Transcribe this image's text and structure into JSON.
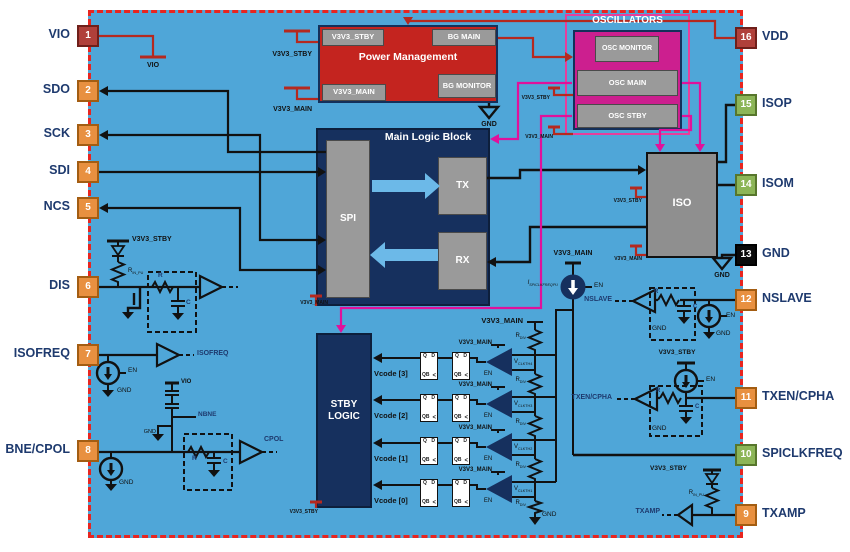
{
  "pins": {
    "left": [
      {
        "num": "1",
        "label": "VIO",
        "type": "power"
      },
      {
        "num": "2",
        "label": "SDO",
        "type": "io"
      },
      {
        "num": "3",
        "label": "SCK",
        "type": "io"
      },
      {
        "num": "4",
        "label": "SDI",
        "type": "io"
      },
      {
        "num": "5",
        "label": "NCS",
        "type": "io"
      },
      {
        "num": "6",
        "label": "DIS",
        "type": "io"
      },
      {
        "num": "7",
        "label": "ISOFREQ",
        "type": "io"
      },
      {
        "num": "8",
        "label": "BNE/CPOL",
        "type": "io"
      }
    ],
    "right": [
      {
        "num": "16",
        "label": "VDD",
        "type": "power"
      },
      {
        "num": "15",
        "label": "ISOP",
        "type": "iso"
      },
      {
        "num": "14",
        "label": "ISOM",
        "type": "iso"
      },
      {
        "num": "13",
        "label": "GND",
        "type": "ground"
      },
      {
        "num": "12",
        "label": "NSLAVE",
        "type": "io"
      },
      {
        "num": "11",
        "label": "TXEN/CPHA",
        "type": "io"
      },
      {
        "num": "10",
        "label": "SPICLKFREQ",
        "type": "iso"
      },
      {
        "num": "9",
        "label": "TXAMP",
        "type": "io"
      }
    ]
  },
  "blocks": {
    "power_management": {
      "title": "Power Management",
      "v3v3_stby": "V3V3_STBY",
      "bg_main": "BG MAIN",
      "v3v3_main": "V3V3_MAIN",
      "bg_monitor": "BG MONITOR"
    },
    "oscillators": {
      "title": "OSCILLATORS",
      "osc_monitor": "OSC MONITOR",
      "osc_main": "OSC MAIN",
      "osc_stby": "OSC STBY"
    },
    "main_logic": {
      "title": "Main Logic Block",
      "spi": "SPI",
      "tx": "TX",
      "rx": "RX"
    },
    "iso": {
      "title": "ISO"
    },
    "stby_logic": {
      "line1": "STBY",
      "line2": "LOGIC"
    }
  },
  "labels": {
    "vio": "VIO",
    "v3v3_stby": "V3V3_STBY",
    "v3v3_main": "V3V3_MAIN",
    "gnd": "GND",
    "en": "EN",
    "nbne": "NBNE",
    "isofreq": "ISOFREQ",
    "cpol": "CPOL",
    "nslave": "NSLAVE",
    "txen_cpha": "TXEN/CPHA",
    "txamp": "TXAMP",
    "r": "R",
    "c": "C"
  },
  "subs": {
    "r_in_pu": {
      "base": "R",
      "sub": "IN_PU"
    },
    "i_spiclkfreq": {
      "base": "I",
      "sub": "SPICLKFREQPU"
    },
    "r_div": {
      "base": "R",
      "sub": "DIV"
    }
  },
  "ff": {
    "q": "Q",
    "d": "D",
    "qb": "QB",
    "clk": "<"
  },
  "stby_rows": [
    {
      "vcode": "Vcode [3]",
      "vth_base": "V",
      "vth_sub": "CLKTH4"
    },
    {
      "vcode": "Vcode [2]",
      "vth_base": "V",
      "vth_sub": "CLKTH3"
    },
    {
      "vcode": "Vcode [1]",
      "vth_base": "V",
      "vth_sub": "CLKTH2"
    },
    {
      "vcode": "Vcode [0]",
      "vth_base": "V",
      "vth_sub": "CLKTH1"
    }
  ],
  "colors": {
    "background": "#4fa6d8",
    "border_dash": "#e8251f",
    "block_red": "#c4241f",
    "block_navy": "#16305e",
    "block_magenta": "#cc1f8f",
    "osc_border": "#e83e9c",
    "block_gray": "#9a9a9a",
    "pin_orange": "#e89040",
    "pin_green": "#8cb557",
    "pin_red": "#b0403a",
    "pin_black": "#111111",
    "wire_pink": "#e0119b",
    "wire_red": "#b5291f",
    "arrow_blue": "#6cb9e8"
  }
}
